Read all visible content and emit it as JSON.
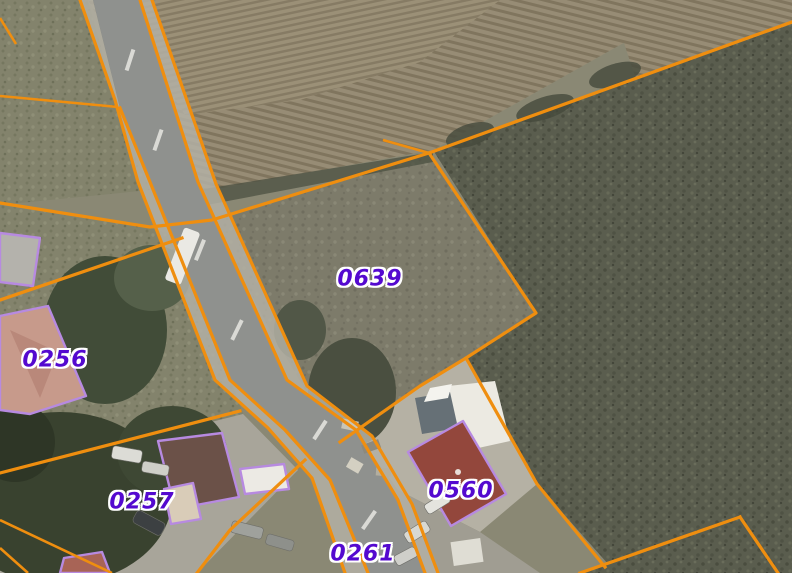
{
  "map": {
    "type": "cadastral-aerial-view",
    "parcel_labels": [
      {
        "id": "0639",
        "x": 370,
        "y": 279
      },
      {
        "id": "0256",
        "x": 55,
        "y": 360
      },
      {
        "id": "0257",
        "x": 142,
        "y": 502
      },
      {
        "id": "0560",
        "x": 461,
        "y": 491
      },
      {
        "id": "0261",
        "x": 363,
        "y": 554
      },
      {
        "id": "6",
        "x": -13,
        "y": 208,
        "partial": true
      }
    ],
    "colors": {
      "parcel_boundary": "#ef8e0f",
      "building_outline": "#b78ae0",
      "label_text": "#5409cf",
      "label_halo": "#ffffff"
    }
  }
}
